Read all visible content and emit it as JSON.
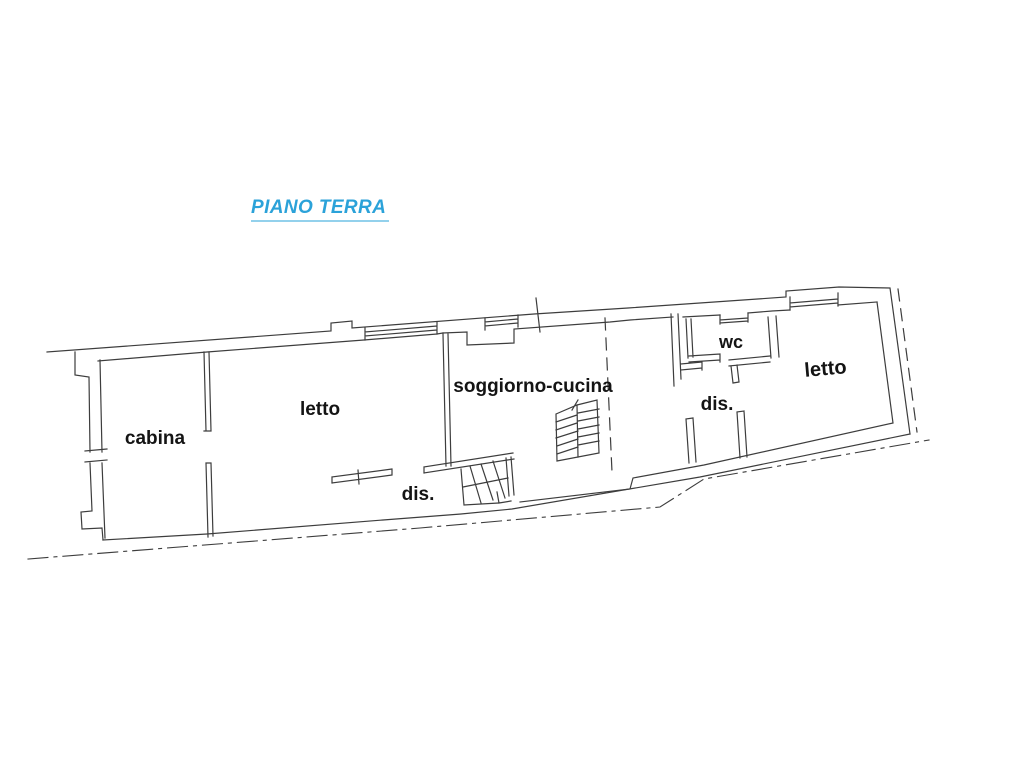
{
  "title": {
    "text": "PIANO TERRA",
    "color": "#2ba2d9",
    "underline_color": "#93d1ec"
  },
  "plan": {
    "line_color": "#3d3d3d",
    "rooms": [
      {
        "id": "cabina",
        "label": "cabina"
      },
      {
        "id": "letto-left",
        "label": "letto"
      },
      {
        "id": "soggiorno-cucina",
        "label": "soggiorno-cucina"
      },
      {
        "id": "dis-center",
        "label": "dis."
      },
      {
        "id": "wc",
        "label": "wc"
      },
      {
        "id": "dis-right",
        "label": "dis."
      },
      {
        "id": "letto-right",
        "label": "letto"
      }
    ]
  }
}
